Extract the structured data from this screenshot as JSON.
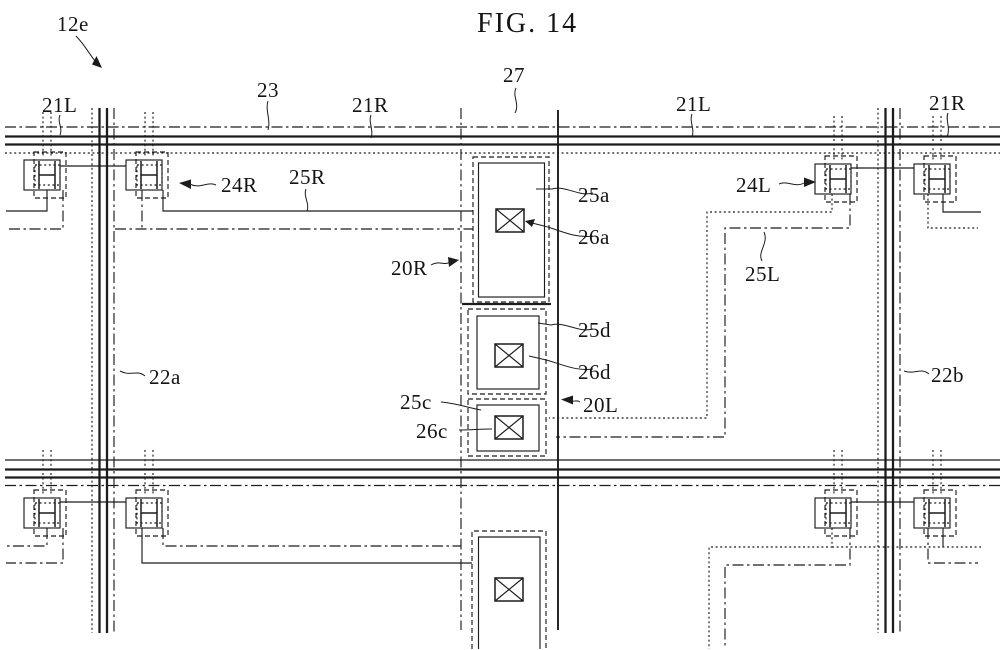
{
  "figure": {
    "title": "FIG. 14",
    "ink_color": "#1c1c1c",
    "paper_color": "#ffffff"
  },
  "labels": {
    "ref_12e": "12e",
    "ref_21L_left": "21L",
    "ref_23": "23",
    "ref_21R_mid": "21R",
    "ref_27": "27",
    "ref_21L_right": "21L",
    "ref_21R_right": "21R",
    "ref_24R": "24R",
    "ref_25R": "25R",
    "ref_24L": "24L",
    "ref_25L": "25L",
    "ref_25a": "25a",
    "ref_26a": "26a",
    "ref_20R": "20R",
    "ref_25d": "25d",
    "ref_26d": "26d",
    "ref_25c": "25c",
    "ref_26c": "26c",
    "ref_20L": "20L",
    "ref_22a": "22a",
    "ref_22b": "22b"
  }
}
